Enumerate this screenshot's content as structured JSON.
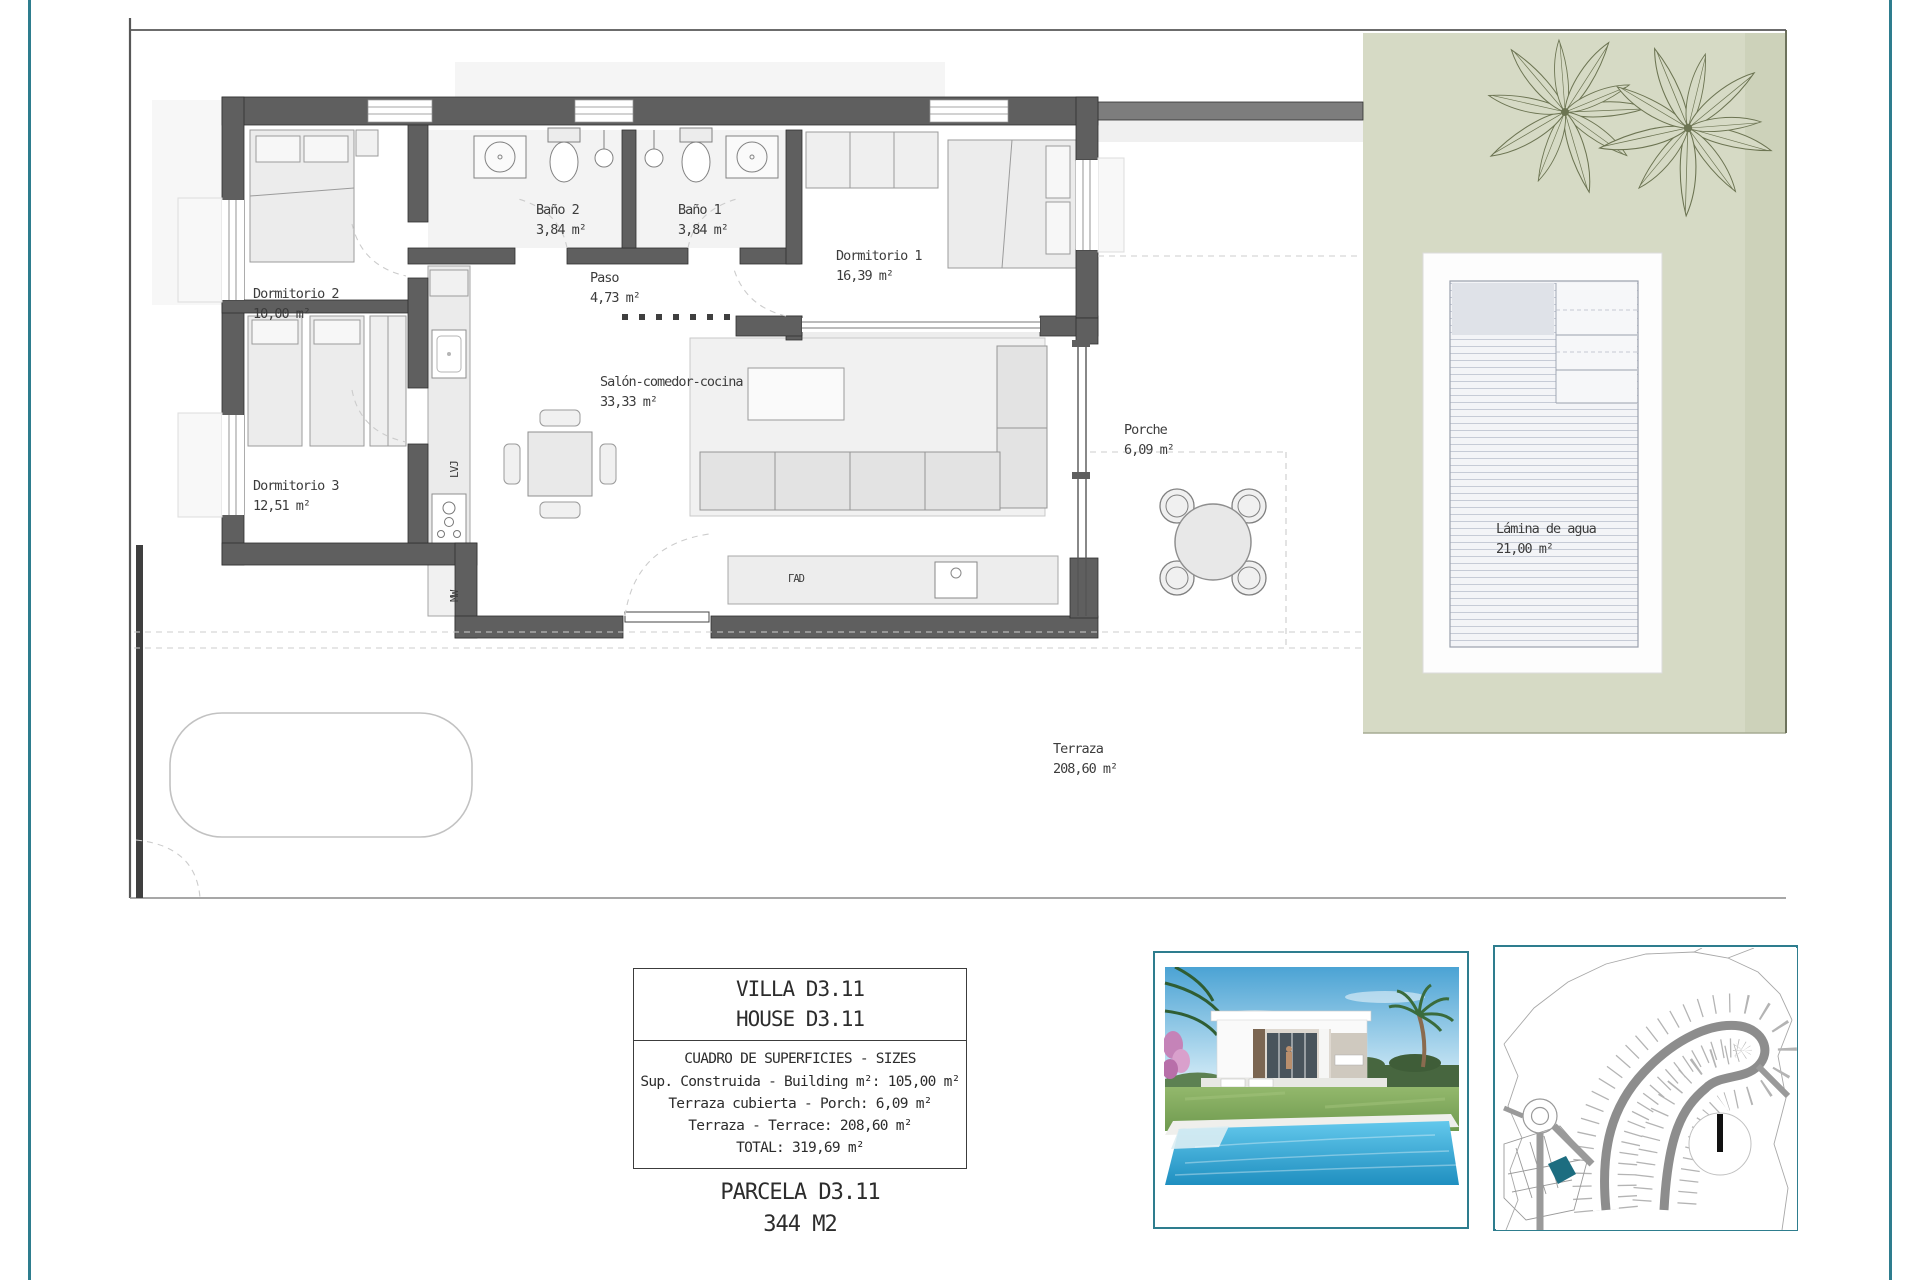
{
  "page": {
    "border_color": "#2e7d8e",
    "green_color": "#d6dac5",
    "wall_color": "#5f5f5f"
  },
  "plan": {
    "rooms": [
      {
        "name": "Dormitorio 2",
        "area": "10,00 m²"
      },
      {
        "name": "Dormitorio 3",
        "area": "12,51 m²"
      },
      {
        "name": "Baño 2",
        "area": "3,84 m²"
      },
      {
        "name": "Baño 1",
        "area": "3,84 m²"
      },
      {
        "name": "Paso",
        "area": "4,73 m²"
      },
      {
        "name": "Dormitorio 1",
        "area": "16,39 m²"
      },
      {
        "name": "Salón-comedor-cocina",
        "area": "33,33 m²"
      },
      {
        "name": "Porche",
        "area": "6,09 m²"
      },
      {
        "name": "Terraza",
        "area": "208,60 m²"
      },
      {
        "name": "Lámina de agua",
        "area": "21,00 m²"
      }
    ],
    "appliances": {
      "dishwasher": "LVJ",
      "microwave": "MW",
      "sideboard": "ΓAD"
    }
  },
  "panel": {
    "villa_title": "VILLA D3.11",
    "house_title": "HOUSE D3.11",
    "table_title": "CUADRO DE SUPERFICIES  - SIZES",
    "rows": [
      "Sup. Construida  - Building m²: 105,00 m²",
      "Terraza cubierta  - Porch: 6,09 m²",
      "Terraza - Terrace: 208,60 m²",
      "TOTAL:  319,69 m²"
    ],
    "parcel_title": "PARCELA D3.11",
    "parcel_area": "344 M2"
  }
}
